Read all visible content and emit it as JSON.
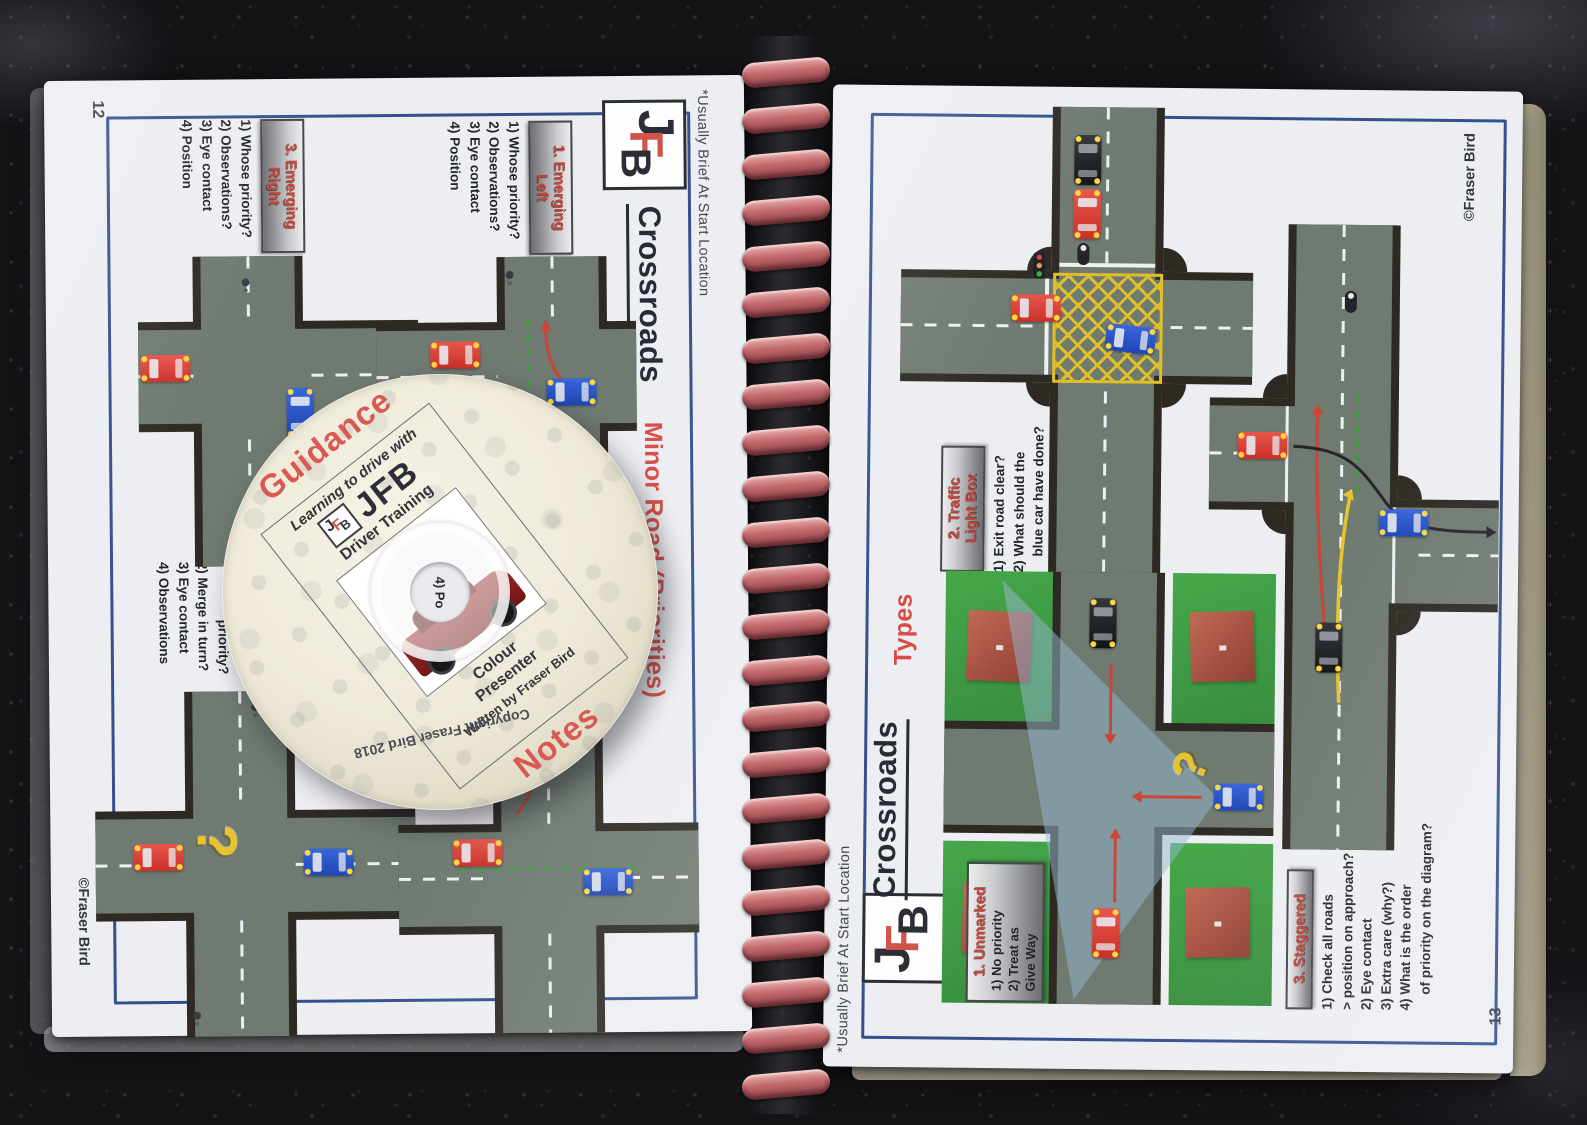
{
  "logo": {
    "j": "J",
    "f": "F",
    "b": "B"
  },
  "left_page": {
    "page_number": "12",
    "margin_note": "*Usually Brief At Start Location",
    "title": "Crossroads",
    "subtitle": "Minor Road (Priorities)",
    "copyright": "©Fraser Bird",
    "question_mark": "?",
    "section_emerging_left": {
      "heading": [
        "1. Emerging",
        "Left"
      ],
      "items": [
        "1) Whose priority?",
        "2) Observations?",
        "3) Eye contact",
        "4) Position"
      ]
    },
    "section_emerging_right": {
      "heading": [
        "3. Emerging",
        "Right"
      ],
      "items": [
        "1) Whose priority?",
        "2) Observations?",
        "3) Eye contact",
        "4) Position"
      ]
    },
    "section_partial": {
      "items": [
        "priority?",
        "2) Merge in turn?",
        "3) Eye contact",
        "4) Observations"
      ]
    }
  },
  "right_page": {
    "page_number": "13",
    "margin_note": "*Usually Brief At Start Location",
    "title": "Crossroads",
    "subtitle": "Types",
    "copyright": "©Fraser Bird",
    "question_mark": "?",
    "section_unmarked": {
      "heading": [
        "1. Unmarked"
      ],
      "items": [
        "1) No priority",
        "2) Treat as",
        "Give Way"
      ]
    },
    "section_traffic_light": {
      "heading": [
        "2. Traffic",
        "Light Box"
      ],
      "items": [
        "1) Exit road clear?",
        "2) What should the",
        "blue car have done?"
      ]
    },
    "section_staggered": {
      "heading": [
        "3. Staggered"
      ],
      "items": [
        "1) Check all roads",
        "> position on approach?",
        "2) Eye contact",
        "3) Extra care (why?)",
        "4) What is the order",
        "of priority on the diagram?"
      ]
    }
  },
  "disc": {
    "guidance": "Guidance",
    "tagline": "Learning to drive with",
    "brand": "JFB",
    "brand_sub": "Driver Training",
    "product_line1": "Colour",
    "product_line2": "Presenter",
    "author": "Written by Fraser Bird",
    "notes": "Notes",
    "copyright": "Copyright Fraser Bird 2018",
    "hole_text": "4) Po"
  },
  "colors": {
    "accent_red": "#d94b45",
    "border_blue": "#33518f",
    "road_surface": "#6f7a71",
    "road_edge": "#2e2a23",
    "grass_green": "#3fa045",
    "building_brown": "#b05a4a",
    "box_yellow": "#e0bf2b",
    "spiral_pink": "#c4696c"
  }
}
